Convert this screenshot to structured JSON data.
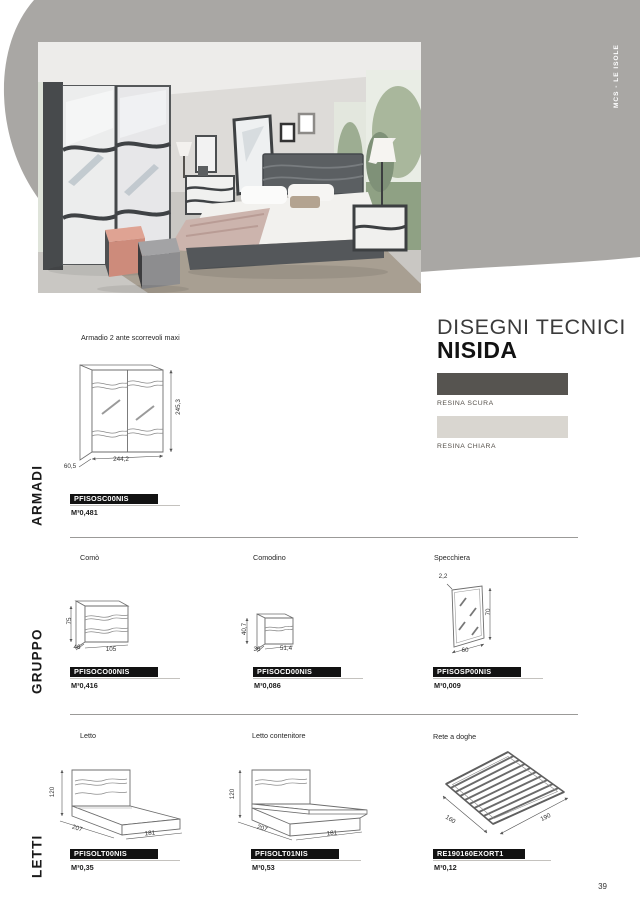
{
  "page": {
    "number": "39"
  },
  "brand": {
    "vertical_label": "MCS - LE ISOLE"
  },
  "header": {
    "title": "DISEGNI TECNICI",
    "collection": "NISIDA"
  },
  "finishes": {
    "dark": {
      "label": "RESINA SCURA",
      "color": "#565450"
    },
    "light": {
      "label": "RESINA CHIARA",
      "color": "#d9d6d0"
    }
  },
  "sections": {
    "armadi": {
      "label": "ARMADI",
      "armadio": {
        "name": "Armadio 2 ante scorrevoli maxi",
        "code": "PFISOSC00NIS",
        "volume": "M³0,481",
        "dims": {
          "height": "245,3",
          "width": "244,2",
          "depth": "60,5"
        }
      }
    },
    "gruppo": {
      "label": "GRUPPO",
      "como": {
        "name": "Comò",
        "code": "PFISOCO00NIS",
        "volume": "M³0,416",
        "dims": {
          "height": "75",
          "depth": "46",
          "width": "105"
        }
      },
      "comodino": {
        "name": "Comodino",
        "code": "PFISOCD00NIS",
        "volume": "M³0,086",
        "dims": {
          "height": "40,7",
          "depth": "36",
          "width": "51,4"
        }
      },
      "specchiera": {
        "name": "Specchiera",
        "code": "PFISOSP00NIS",
        "volume": "M³0,009",
        "dims": {
          "thickness": "2,2",
          "height": "70",
          "width": "60"
        }
      }
    },
    "letti": {
      "label": "LETTI",
      "letto": {
        "name": "Letto",
        "code": "PFISOLT00NIS",
        "volume": "M³0,35",
        "dims": {
          "height": "120",
          "depth": "207",
          "width": "181"
        }
      },
      "letto_contenitore": {
        "name": "Letto contenitore",
        "code": "PFISOLT01NIS",
        "volume": "M³0,53",
        "dims": {
          "height": "120",
          "depth": "207",
          "width": "181"
        }
      },
      "rete": {
        "name": "Rete a doghe",
        "code": "RE190160EXORT1",
        "volume": "M³0,12",
        "dims": {
          "depth": "160",
          "width": "190"
        }
      }
    }
  }
}
